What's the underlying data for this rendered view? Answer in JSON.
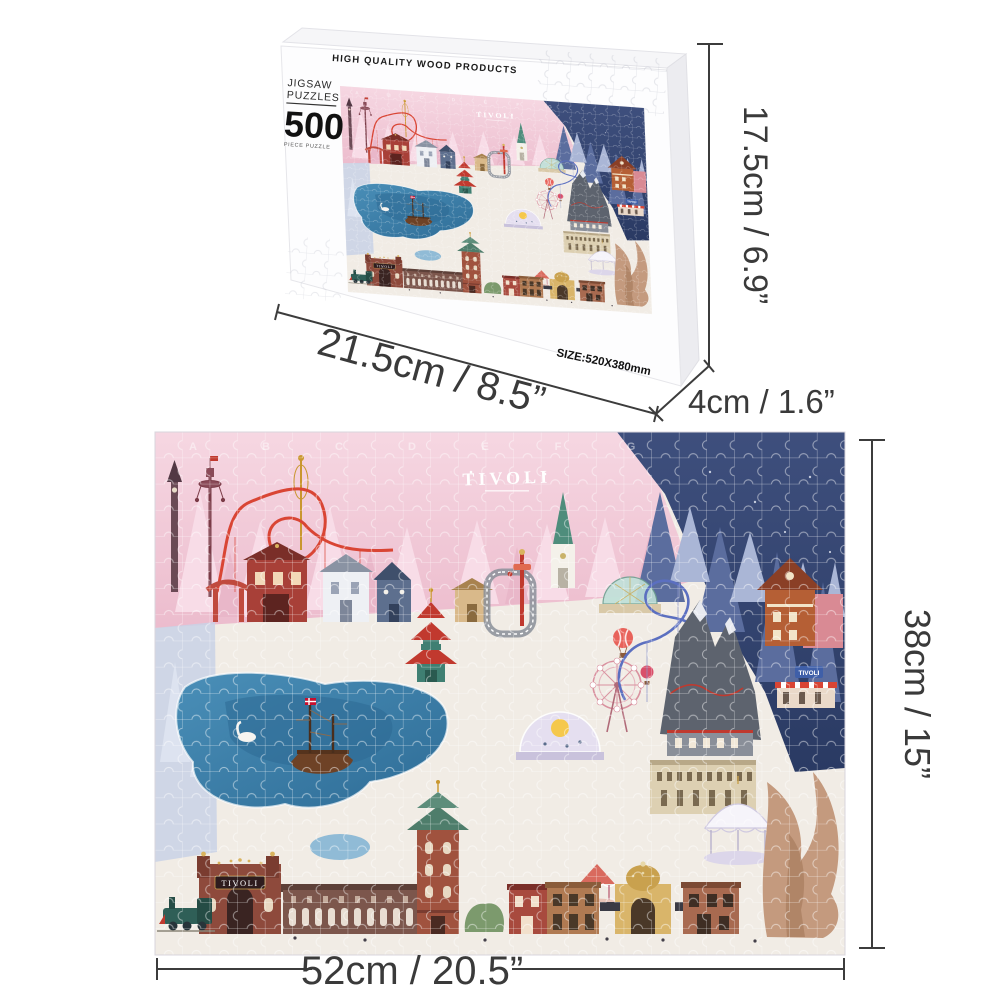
{
  "box": {
    "lid_text": "HIGH QUALITY WOOD PRODUCTS",
    "label": {
      "brand_line1": "JIGSAW",
      "brand_line2": "PUZZLES",
      "piece_count": "500",
      "piece_text": "PIECE PUZZLE"
    },
    "size_text": "SIZE:520X380mm"
  },
  "dimensions": {
    "box_height": "17.5cm / 6.9”",
    "box_width": "21.5cm / 8.5”",
    "box_depth": "4cm / 1.6”",
    "puzzle_height": "38cm / 15”",
    "puzzle_width": "52cm / 20.5”"
  },
  "puzzle": {
    "logo": "TIVOLI",
    "entrance_sign": "TIVOLI",
    "small_sign": "TIVOLI",
    "grid_letters": [
      "A",
      "B",
      "C",
      "D",
      "E",
      "F",
      "G"
    ],
    "colors": {
      "sky_pink": "#efc6d4",
      "sky_navy": "#31416b",
      "ground": "#f1ece5",
      "lake": "#3f7ea8",
      "coaster_red": "#d94534",
      "coaster_blue": "#5b6fc0",
      "brick": "#8e4a3c",
      "dimension_line": "#3c3c3c"
    }
  }
}
